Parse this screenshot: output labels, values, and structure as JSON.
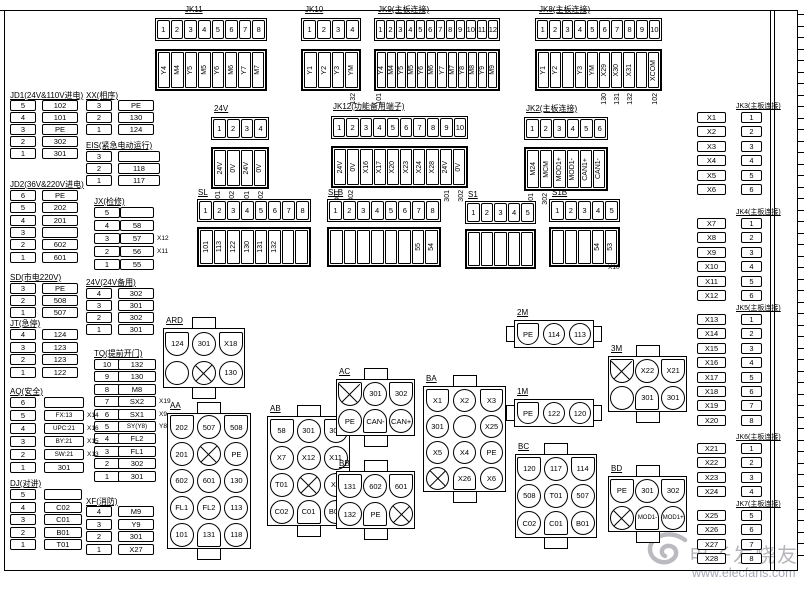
{
  "watermark": {
    "logo": "elecfans-swirl-logo",
    "title": "电子发烧友",
    "url": "www.elecfans.com"
  },
  "strips": {
    "jk11": {
      "title": "JK11",
      "pins": [
        "1",
        "2",
        "3",
        "4",
        "5",
        "6",
        "7",
        "8"
      ],
      "labels": [
        "Y4",
        "M4",
        "Y5",
        "M5",
        "Y6",
        "M6",
        "Y7",
        "M7"
      ],
      "subs": [
        "",
        "",
        "",
        "",
        "",
        "",
        "",
        ""
      ]
    },
    "jk10": {
      "title": "JK10",
      "pins": [
        "1",
        "2",
        "3",
        "4"
      ],
      "labels": [
        "Y1",
        "Y2",
        "Y3",
        "YM"
      ],
      "subs": [
        "",
        "",
        "",
        "132"
      ]
    },
    "jk9": {
      "title": "JK9(主板连接)",
      "pins": [
        "1",
        "2",
        "3",
        "4",
        "5",
        "6",
        "7",
        "8",
        "9",
        "10",
        "11",
        "12"
      ],
      "labels": [
        "Y4",
        "M4",
        "Y5",
        "M5",
        "Y6",
        "M6",
        "Y7",
        "M7",
        "Y8",
        "M8",
        "Y9",
        "M9"
      ],
      "subs": [
        "101",
        "",
        "",
        "",
        "",
        "",
        "",
        "",
        "",
        "",
        "",
        ""
      ]
    },
    "jk8": {
      "title": "JK8(主板连接)",
      "pins": [
        "1",
        "2",
        "3",
        "4",
        "5",
        "6",
        "7",
        "8",
        "9",
        "10"
      ],
      "labels": [
        "Y1",
        "Y2",
        "",
        "Y3",
        "YM",
        "X29",
        "X30",
        "X31",
        "",
        "XCOM"
      ],
      "subs": [
        "",
        "",
        "",
        "",
        "",
        "130",
        "131",
        "132",
        "",
        "102"
      ]
    },
    "v24": {
      "title": "24V",
      "pins": [
        "1",
        "2",
        "3",
        "4"
      ],
      "labels": [
        "24V",
        "0V",
        "24V",
        "0V"
      ],
      "subs": [
        "301",
        "302",
        "301",
        "302"
      ]
    },
    "jk12": {
      "title": "JK12(功能备用端子)",
      "pins": [
        "1",
        "2",
        "3",
        "4",
        "5",
        "6",
        "7",
        "8",
        "9",
        "10"
      ],
      "labels": [
        "24V",
        "0V",
        "X16",
        "X17",
        "X20",
        "X23",
        "X24",
        "X28",
        "24V",
        "0V"
      ],
      "subs": [
        "301",
        "302",
        "",
        "",
        "",
        "",
        "",
        "",
        "301",
        "302"
      ]
    },
    "jk2": {
      "title": "JK2(主板连接)",
      "pins": [
        "1",
        "2",
        "3",
        "4",
        "5",
        "6"
      ],
      "labels": [
        "M24",
        "MCM",
        "MOD1+",
        "MOD1-",
        "CAN1+",
        "CAN1-"
      ],
      "subs": [
        "301",
        "302",
        "",
        "",
        "",
        ""
      ]
    },
    "sl": {
      "title": "SL",
      "pins": [
        "1",
        "2",
        "3",
        "4",
        "5",
        "6",
        "7",
        "8"
      ],
      "labels": [
        "101",
        "113",
        "122",
        "130",
        "131",
        "132",
        "",
        ""
      ],
      "subs": []
    },
    "slb": {
      "title": "SLB",
      "pins": [
        "1",
        "2",
        "3",
        "4",
        "5",
        "6",
        "7",
        "8"
      ],
      "labels": [
        "",
        "",
        "",
        "",
        "",
        "",
        "55",
        "54"
      ],
      "subs": []
    },
    "s1": {
      "title": "S1",
      "pins": [
        "1",
        "2",
        "3",
        "4",
        "5"
      ],
      "labels": [
        "",
        "",
        "",
        "",
        ""
      ],
      "subs": []
    },
    "s1b": {
      "title": "S1B",
      "pins": [
        "1",
        "2",
        "3",
        "4",
        "5"
      ],
      "labels": [
        "",
        "",
        "",
        "54",
        "53"
      ],
      "subs": [],
      "annotation": "X10"
    }
  },
  "lists": {
    "jd1": {
      "title": "JD1(24V&110V进电)",
      "rows": [
        {
          "n": "5",
          "v": "102"
        },
        {
          "n": "4",
          "v": "101"
        },
        {
          "n": "3",
          "v": "PE"
        },
        {
          "n": "2",
          "v": "302"
        },
        {
          "n": "1",
          "v": "301"
        }
      ]
    },
    "xx": {
      "title": "XX(相序)",
      "rows": [
        {
          "n": "3",
          "v": "PE"
        },
        {
          "n": "2",
          "v": "130"
        },
        {
          "n": "1",
          "v": "124"
        }
      ]
    },
    "eis": {
      "title": "EIS(紧急电动运行)",
      "rows": [
        {
          "n": "3",
          "v": ""
        },
        {
          "n": "2",
          "v": "118"
        },
        {
          "n": "1",
          "v": "117"
        }
      ]
    },
    "jd2": {
      "title": "JD2(36V&220V进电)",
      "rows": [
        {
          "n": "6",
          "v": "PE"
        },
        {
          "n": "5",
          "v": "202"
        },
        {
          "n": "4",
          "v": "201"
        },
        {
          "n": "3",
          "v": ""
        },
        {
          "n": "2",
          "v": "602"
        },
        {
          "n": "1",
          "v": "601"
        }
      ]
    },
    "jx": {
      "title": "JX(检修)",
      "rows": [
        {
          "n": "5",
          "v": ""
        },
        {
          "n": "4",
          "v": "58"
        },
        {
          "n": "3",
          "v": "57",
          "a": "X12"
        },
        {
          "n": "2",
          "v": "56",
          "a": "X11"
        },
        {
          "n": "1",
          "v": "55"
        }
      ]
    },
    "sd": {
      "title": "SD(市电220V)",
      "rows": [
        {
          "n": "3",
          "v": "PE"
        },
        {
          "n": "2",
          "v": "508"
        },
        {
          "n": "1",
          "v": "507"
        }
      ]
    },
    "v24b": {
      "title": "24V(24V备用)",
      "rows": [
        {
          "n": "4",
          "v": "302"
        },
        {
          "n": "3",
          "v": "301"
        },
        {
          "n": "2",
          "v": "302"
        },
        {
          "n": "1",
          "v": "301"
        }
      ]
    },
    "jt": {
      "title": "JT(急停)",
      "rows": [
        {
          "n": "4",
          "v": "124"
        },
        {
          "n": "3",
          "v": "123"
        },
        {
          "n": "2",
          "v": "123"
        },
        {
          "n": "1",
          "v": "122"
        }
      ]
    },
    "tq": {
      "title": "TQ(提前开门)",
      "rows": [
        {
          "n": "10",
          "v": "132"
        },
        {
          "n": "9",
          "v": "130"
        },
        {
          "n": "8",
          "v": "M8"
        },
        {
          "n": "7",
          "v": "SX2",
          "a": "X19"
        },
        {
          "n": "6",
          "v": "SX1",
          "a": "X9"
        },
        {
          "n": "5",
          "v": "SY(Y8)",
          "a": "Y8"
        },
        {
          "n": "4",
          "v": "FL2"
        },
        {
          "n": "3",
          "v": "FL1"
        },
        {
          "n": "2",
          "v": "302"
        },
        {
          "n": "1",
          "v": "301"
        }
      ]
    },
    "aq": {
      "title": "AQ(安全)",
      "rows": [
        {
          "n": "6",
          "v": ""
        },
        {
          "n": "5",
          "v": "FX:13",
          "a": "X14"
        },
        {
          "n": "4",
          "v": "UPC:21",
          "a": "X16"
        },
        {
          "n": "3",
          "v": "BY:21",
          "a": "X15"
        },
        {
          "n": "2",
          "v": "SW:21",
          "a": "X13"
        },
        {
          "n": "1",
          "v": "301"
        }
      ]
    },
    "dj": {
      "title": "DJ(对讲)",
      "rows": [
        {
          "n": "5",
          "v": ""
        },
        {
          "n": "4",
          "v": "C02"
        },
        {
          "n": "3",
          "v": "C01"
        },
        {
          "n": "2",
          "v": "B01"
        },
        {
          "n": "1",
          "v": "T01"
        }
      ]
    },
    "xf": {
      "title": "XF(消防)",
      "rows": [
        {
          "n": "4",
          "v": "M9"
        },
        {
          "n": "3",
          "v": "Y9"
        },
        {
          "n": "2",
          "v": "301"
        },
        {
          "n": "1",
          "v": "X27"
        }
      ]
    }
  },
  "right_lists": {
    "jk3": {
      "title": "JK3(主板连接)",
      "rows": [
        {
          "x": "X1",
          "pin": "1"
        },
        {
          "x": "X2",
          "pin": "2"
        },
        {
          "x": "X3",
          "pin": "3"
        },
        {
          "x": "X4",
          "pin": "4"
        },
        {
          "x": "X5",
          "pin": "5"
        },
        {
          "x": "X6",
          "pin": "6"
        }
      ]
    },
    "jk4": {
      "title": "JK4(主板连接)",
      "rows": [
        {
          "x": "X7",
          "pin": "1"
        },
        {
          "x": "X8",
          "pin": "2"
        },
        {
          "x": "X9",
          "pin": "3"
        },
        {
          "x": "X10",
          "pin": "4"
        },
        {
          "x": "X11",
          "pin": "5"
        },
        {
          "x": "X12",
          "pin": "6"
        }
      ]
    },
    "jk5": {
      "title": "JK5(主板连接)",
      "rows": [
        {
          "x": "X13",
          "pin": "1"
        },
        {
          "x": "X14",
          "pin": "2"
        },
        {
          "x": "X15",
          "pin": "3"
        },
        {
          "x": "X16",
          "pin": "4"
        },
        {
          "x": "X17",
          "pin": "5"
        },
        {
          "x": "X18",
          "pin": "6"
        },
        {
          "x": "X19",
          "pin": "7"
        },
        {
          "x": "X20",
          "pin": "8"
        }
      ]
    },
    "jk6": {
      "title": "JK6(主板连接)",
      "rows": [
        {
          "x": "X21",
          "pin": "1"
        },
        {
          "x": "X22",
          "pin": "2"
        },
        {
          "x": "X23",
          "pin": "3"
        },
        {
          "x": "X24",
          "pin": "4"
        }
      ]
    },
    "jk7": {
      "title": "JK7(主板连接)",
      "rows": [
        {
          "x": "X25",
          "pin": "5"
        },
        {
          "x": "X26",
          "pin": "6"
        },
        {
          "x": "X27",
          "pin": "7"
        },
        {
          "x": "X28",
          "pin": "8"
        }
      ]
    }
  },
  "blocks": {
    "ard": {
      "title": "ARD",
      "rows": [
        [
          {
            "v": "124",
            "s": "ft"
          },
          {
            "v": "301",
            "s": "c"
          },
          {
            "v": "X18",
            "s": "ft"
          }
        ],
        [
          {
            "v": "",
            "s": "c"
          },
          {
            "v": "",
            "s": "cx"
          },
          {
            "v": "130",
            "s": "c"
          }
        ]
      ]
    },
    "aa": {
      "title": "AA",
      "rows": [
        [
          {
            "v": "202",
            "s": "ft"
          },
          {
            "v": "507",
            "s": "c"
          },
          {
            "v": "508",
            "s": "ft"
          }
        ],
        [
          {
            "v": "201",
            "s": "c"
          },
          {
            "v": "",
            "s": "cx"
          },
          {
            "v": "PE",
            "s": "c"
          }
        ],
        [
          {
            "v": "602",
            "s": "c"
          },
          {
            "v": "601",
            "s": "c"
          },
          {
            "v": "130",
            "s": "c"
          }
        ],
        [
          {
            "v": "FL1",
            "s": "c"
          },
          {
            "v": "FL2",
            "s": "c"
          },
          {
            "v": "113",
            "s": "c"
          }
        ],
        [
          {
            "v": "101",
            "s": "c"
          },
          {
            "v": "131",
            "s": "fb"
          },
          {
            "v": "118",
            "s": "c"
          }
        ]
      ]
    },
    "ab": {
      "title": "AB",
      "rows": [
        [
          {
            "v": "58",
            "s": "ft"
          },
          {
            "v": "301",
            "s": "c"
          },
          {
            "v": "302",
            "s": "ft"
          }
        ],
        [
          {
            "v": "X7",
            "s": "c"
          },
          {
            "v": "X12",
            "s": "c"
          },
          {
            "v": "X11",
            "s": "c"
          }
        ],
        [
          {
            "v": "T01",
            "s": "c"
          },
          {
            "v": "",
            "s": "cx"
          },
          {
            "v": "X8",
            "s": "c"
          }
        ],
        [
          {
            "v": "C02",
            "s": "c"
          },
          {
            "v": "C01",
            "s": "fb"
          },
          {
            "v": "B01",
            "s": "c"
          }
        ]
      ]
    },
    "ac": {
      "title": "AC",
      "rows": [
        [
          {
            "v": "",
            "s": "ftx"
          },
          {
            "v": "301",
            "s": "c"
          },
          {
            "v": "302",
            "s": "ft"
          }
        ],
        [
          {
            "v": "PE",
            "s": "c"
          },
          {
            "v": "CAN-",
            "s": "fb"
          },
          {
            "v": "CAN+",
            "s": "c"
          }
        ]
      ]
    },
    "bb": {
      "title": "BB",
      "rows": [
        [
          {
            "v": "131",
            "s": "ft"
          },
          {
            "v": "602",
            "s": "c"
          },
          {
            "v": "601",
            "s": "ft"
          }
        ],
        [
          {
            "v": "132",
            "s": "c"
          },
          {
            "v": "PE",
            "s": "fb"
          },
          {
            "v": "",
            "s": "cx"
          }
        ]
      ]
    },
    "ba": {
      "title": "BA",
      "rows": [
        [
          {
            "v": "X1",
            "s": "ft"
          },
          {
            "v": "X2",
            "s": "c"
          },
          {
            "v": "X3",
            "s": "ft"
          }
        ],
        [
          {
            "v": "301",
            "s": "c"
          },
          {
            "v": "",
            "s": "c"
          },
          {
            "v": "X25",
            "s": "c"
          }
        ],
        [
          {
            "v": "X5",
            "s": "c"
          },
          {
            "v": "X4",
            "s": "c"
          },
          {
            "v": "PE",
            "s": "c"
          }
        ],
        [
          {
            "v": "",
            "s": "cx"
          },
          {
            "v": "X26",
            "s": "fb"
          },
          {
            "v": "X6",
            "s": "c"
          }
        ]
      ]
    },
    "m2": {
      "title": "2M",
      "rows": [
        [
          {
            "v": "PE",
            "s": "ft"
          },
          {
            "v": "114",
            "s": "c"
          },
          {
            "v": "113",
            "s": "c"
          }
        ]
      ]
    },
    "m1": {
      "title": "1M",
      "rows": [
        [
          {
            "v": "PE",
            "s": "ft"
          },
          {
            "v": "122",
            "s": "c"
          },
          {
            "v": "120",
            "s": "c"
          }
        ]
      ]
    },
    "m3": {
      "title": "3M",
      "rows": [
        [
          {
            "v": "",
            "s": "ftx"
          },
          {
            "v": "X22",
            "s": "c"
          },
          {
            "v": "X21",
            "s": "ft"
          }
        ],
        [
          {
            "v": "",
            "s": "c"
          },
          {
            "v": "301",
            "s": "fb"
          },
          {
            "v": "301",
            "s": "c"
          }
        ]
      ]
    },
    "bc": {
      "title": "BC",
      "rows": [
        [
          {
            "v": "120",
            "s": "ft"
          },
          {
            "v": "117",
            "s": "c"
          },
          {
            "v": "114",
            "s": "ft"
          }
        ],
        [
          {
            "v": "508",
            "s": "c"
          },
          {
            "v": "T01",
            "s": "c"
          },
          {
            "v": "507",
            "s": "c"
          }
        ],
        [
          {
            "v": "C02",
            "s": "c"
          },
          {
            "v": "C01",
            "s": "fb"
          },
          {
            "v": "B01",
            "s": "c"
          }
        ]
      ]
    },
    "bd": {
      "title": "BD",
      "rows": [
        [
          {
            "v": "PE",
            "s": "ft"
          },
          {
            "v": "301",
            "s": "c"
          },
          {
            "v": "302",
            "s": "ft"
          }
        ],
        [
          {
            "v": "",
            "s": "cx"
          },
          {
            "v": "MOD1-",
            "s": "fb"
          },
          {
            "v": "MOD1+",
            "s": "c"
          }
        ]
      ]
    }
  }
}
